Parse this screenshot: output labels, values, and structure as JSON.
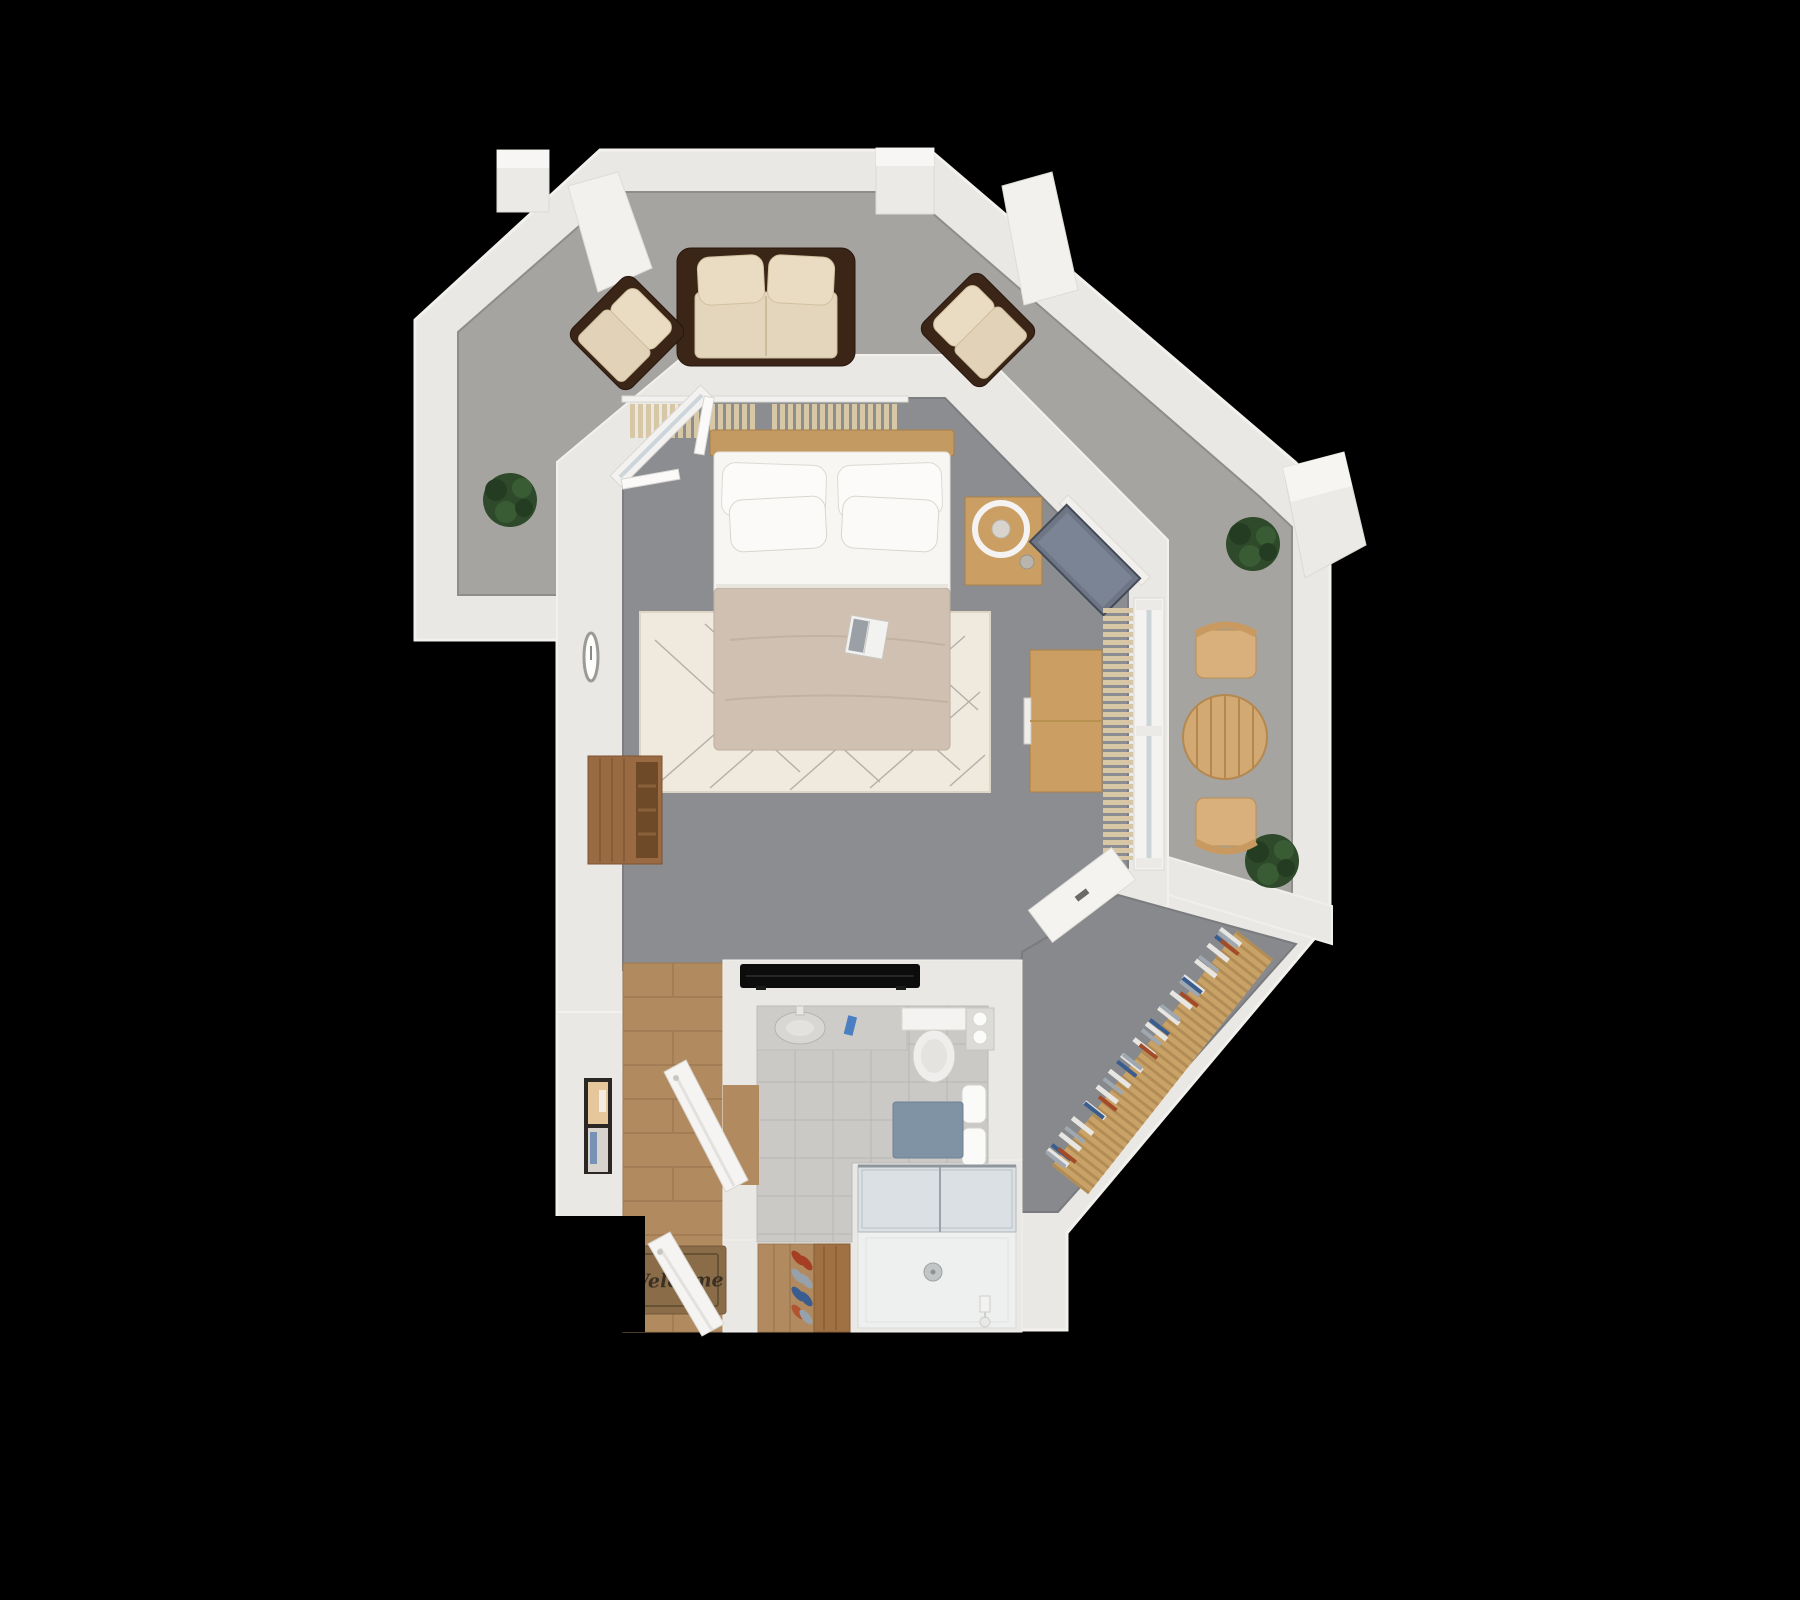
{
  "scene": {
    "description": "3D rendered top-down floor plan of a studio apartment with wrap-around terrace, on black background",
    "background": "#000000"
  },
  "mat": {
    "text": "Welcome"
  },
  "palette": {
    "wall": "#eae8e4",
    "wall_highlight": "#f3f2ef",
    "terrace_floor": "#a6a4a1",
    "bedroom_floor": "#8b8d90",
    "closet_floor": "#87898c",
    "wood_floor": "#b18a5f",
    "tile_floor": "#cac9c6",
    "rug": "#efe9de",
    "linen_white": "#f7f6f3",
    "blanket_beige": "#cfc0b1",
    "sofa_frame_brown": "#3a2517",
    "cushion_beige": "#e4d6bc",
    "curtain_beige": "#d8c7a5",
    "furniture_wood": "#cb9f63",
    "outdoor_wood": "#d2a873",
    "plant_green": "#2e4a2a",
    "tv_panel_gray": "#6e7686",
    "tv_black": "#0c0c0c",
    "door_mat_brown": "#8a6c49",
    "bath_mat_blue": "#7f93a4",
    "toothbrush_blue": "#4a7fc1",
    "shoe_red": "#a53e22",
    "shoe_gray": "#97a1ab",
    "shoe_blue": "#3a5d8f"
  },
  "rooms": [
    {
      "name": "terrace",
      "floor": "concrete gray",
      "shape": "L-band along top and right"
    },
    {
      "name": "bedroom",
      "floor": "gray carpet",
      "position": "center"
    },
    {
      "name": "walk-in-closet",
      "floor": "gray carpet",
      "position": "bottom right diagonal"
    },
    {
      "name": "bathroom",
      "floor": "gray tile",
      "position": "bottom center"
    },
    {
      "name": "shower",
      "floor": "white tray",
      "position": "below bathroom"
    },
    {
      "name": "entry-hallway",
      "floor": "wood planks",
      "position": "bottom left"
    }
  ],
  "furniture": {
    "terrace": [
      "outdoor sofa",
      "armchair left",
      "armchair right",
      "round dining table",
      "two folding chairs",
      "potted plant x3"
    ],
    "bedroom": [
      "double bed with four pillows and beige blanket",
      "open book on bed",
      "patterned area rug",
      "curtains behind headboard",
      "casement window",
      "wall clock",
      "wood cabinet",
      "nightstand with ring lamp",
      "wall TV panel on angled wall",
      "dresser",
      "sliding glass door with curtain"
    ],
    "closet": [
      "clothes rail with hanging clothes",
      "white console"
    ],
    "bathroom": [
      "vanity with sink",
      "toothbrush cup",
      "toilet",
      "rolled towels",
      "hanging towels",
      "blue bath mat",
      "glass shower with tray and drain",
      "swing door"
    ],
    "entry": [
      "welcome mat",
      "entry door",
      "wall picture",
      "shoe shelf with shoes",
      "flat TV on bathroom wall"
    ]
  }
}
